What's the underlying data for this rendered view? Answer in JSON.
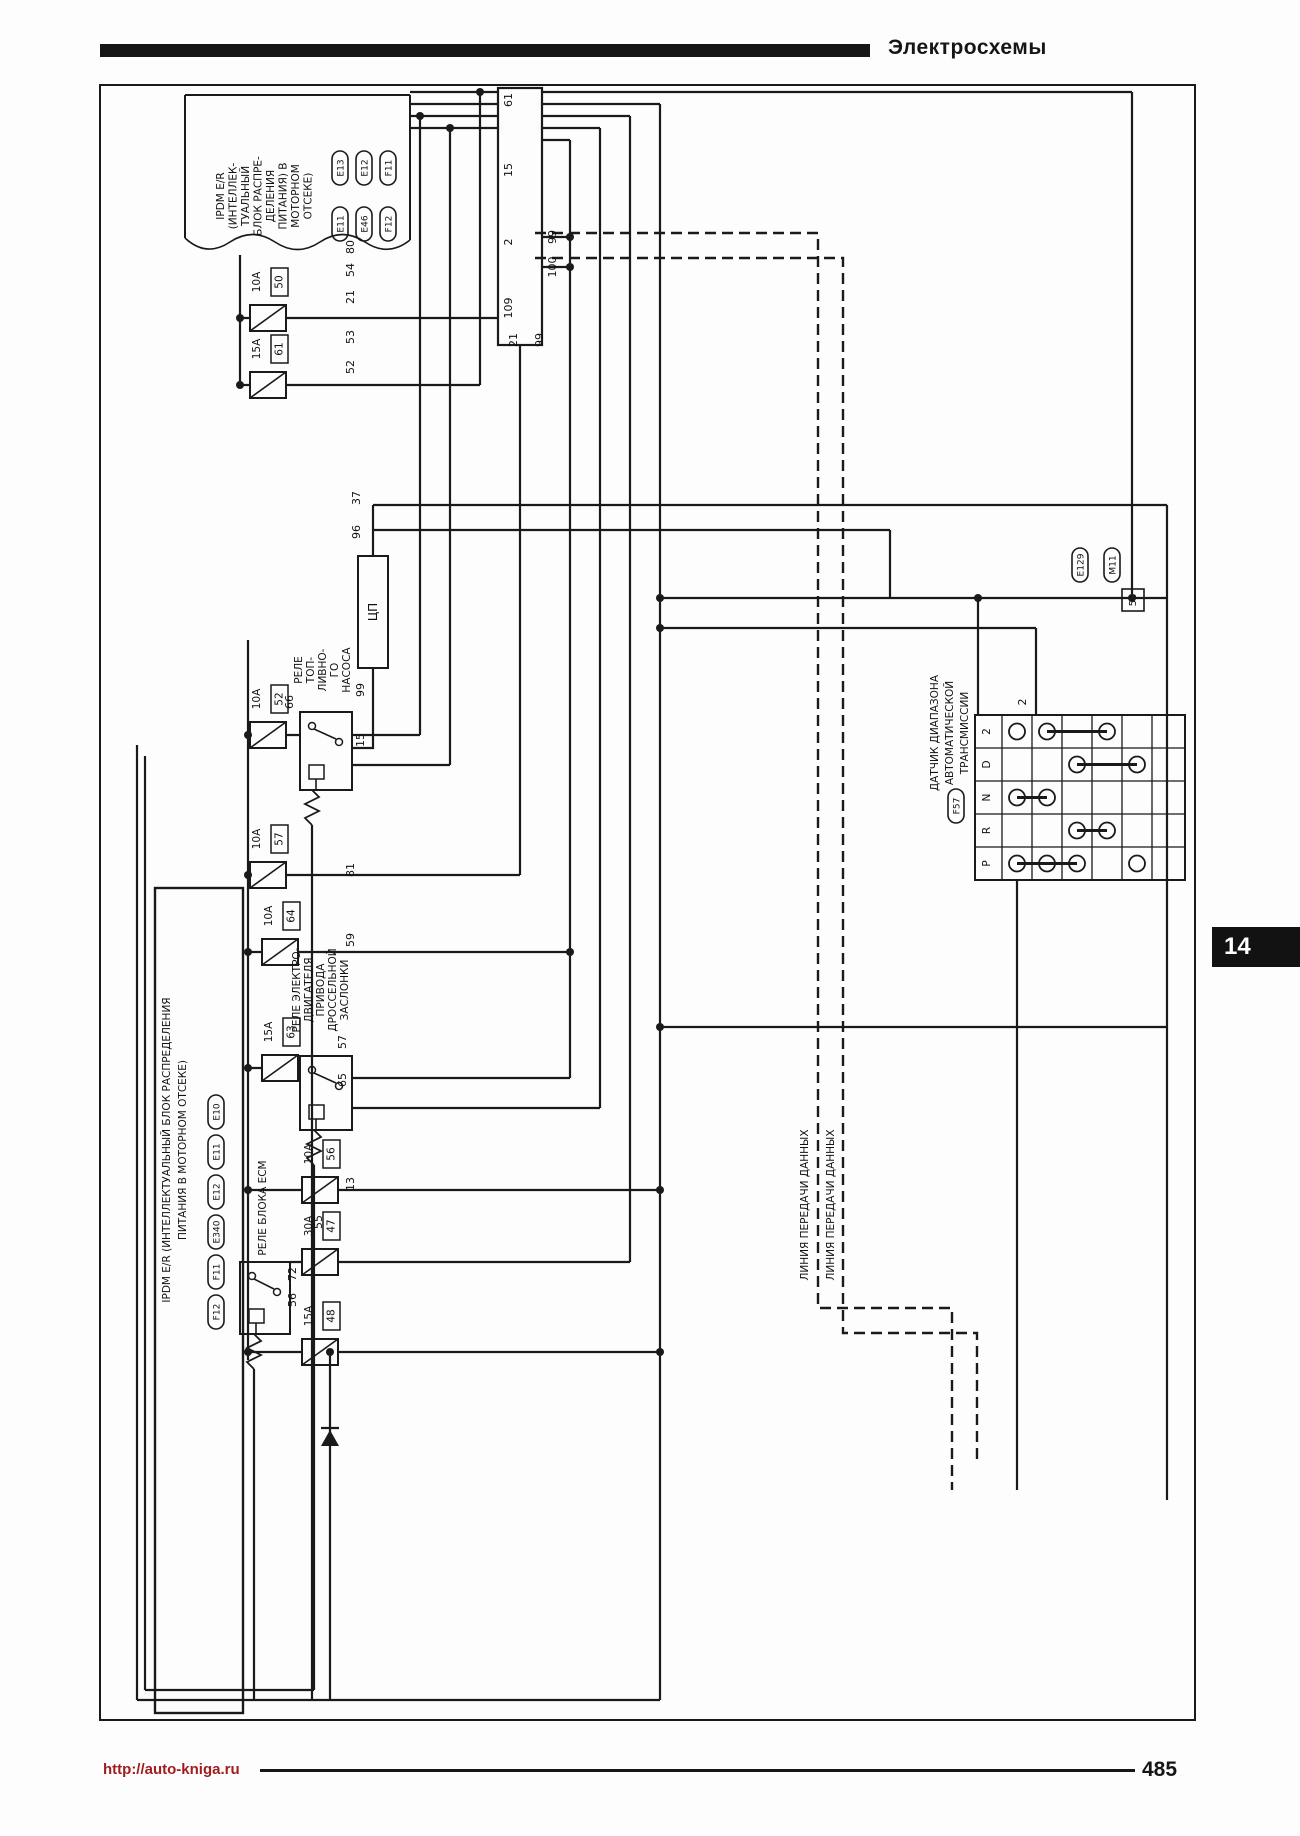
{
  "page": {
    "header_title": "Электросхемы",
    "footer_url": "http://auto-kniga.ru",
    "page_number": "485",
    "chapter_tab": "14"
  },
  "diagram": {
    "top_ipdm": {
      "label_lines": [
        "IPDM E/R",
        "(ИНТЕЛЛЕК-",
        "ТУАЛЬНЫЙ",
        "БЛОК РАСПРЕ-",
        "ДЕЛЕНИЯ",
        "ПИТАНИЯ) В",
        "МОТОРНОМ",
        "ОТСЕКЕ)"
      ],
      "connectors": [
        "E13",
        "E12",
        "F11",
        "E11",
        "E46",
        "F12"
      ]
    },
    "left_ipdm": {
      "label_lines": [
        "IPDM E/R (ИНТЕЛЛЕКТУАЛЬНЫЙ БЛОК РАСПРЕДЕЛЕНИЯ",
        "ПИТАНИЯ В МОТОРНОМ ОТСЕКЕ)"
      ],
      "connectors": [
        "E10",
        "E11",
        "E12",
        "E340",
        "F11",
        "F12"
      ]
    },
    "cpu_label": "ЦП",
    "relays": [
      {
        "name": "fuel-pump-relay",
        "label_lines": [
          "РЕЛЕ",
          "ТОП-",
          "ЛИВНО-",
          "ГО",
          "НАСОСА"
        ]
      },
      {
        "name": "throttle-motor-relay",
        "label_lines": [
          "РЕЛЕ ЭЛЕКТРО-",
          "ДВИГАТЕЛЯ",
          "ПРИВОДА",
          "ДРОССЕЛЬНОЙ",
          "ЗАСЛОНКИ"
        ]
      },
      {
        "name": "ecm-relay",
        "label_lines": [
          "РЕЛЕ БЛОКА ECM"
        ]
      }
    ],
    "fuses": [
      {
        "amp": "10A",
        "num": "50",
        "x": 268,
        "y": 318
      },
      {
        "amp": "15A",
        "num": "61",
        "x": 268,
        "y": 385
      },
      {
        "amp": "10A",
        "num": "52",
        "x": 268,
        "y": 735
      },
      {
        "amp": "10A",
        "num": "57",
        "x": 268,
        "y": 875
      },
      {
        "amp": "10A",
        "num": "64",
        "x": 280,
        "y": 952
      },
      {
        "amp": "15A",
        "num": "63",
        "x": 280,
        "y": 1068
      },
      {
        "amp": "10A",
        "num": "56",
        "x": 320,
        "y": 1190
      },
      {
        "amp": "30A",
        "num": "47",
        "x": 320,
        "y": 1262
      },
      {
        "amp": "15A",
        "num": "48",
        "x": 320,
        "y": 1352
      }
    ],
    "at_sensor": {
      "label_lines": [
        "ДАТЧИК ДИАПАЗОНА",
        "АВТОМАТИЧЕСКОЙ",
        "ТРАНСМИССИИ"
      ],
      "connector": "F57",
      "rows": [
        {
          "pos": "2",
          "circles": [
            0,
            1,
            3
          ],
          "bar": [
            1,
            3
          ]
        },
        {
          "pos": "D",
          "circles": [
            2,
            4
          ],
          "bar": [
            2,
            4
          ]
        },
        {
          "pos": "N",
          "circles": [
            0,
            1
          ],
          "bar": [
            0,
            1
          ]
        },
        {
          "pos": "R",
          "circles": [
            2,
            3
          ],
          "bar": [
            2,
            3
          ]
        },
        {
          "pos": "P",
          "circles": [
            0,
            1,
            2,
            4
          ],
          "bar": [
            0,
            2
          ]
        }
      ]
    },
    "right_connectors": {
      "pills": [
        "E129",
        "M11"
      ],
      "pin_box": "58"
    },
    "data_line_label": "ЛИНИЯ ПЕРЕДАЧИ ДАННЫХ",
    "pin_labels": [
      {
        "t": "61",
        "x": 512,
        "y": 100
      },
      {
        "t": "15",
        "x": 512,
        "y": 170
      },
      {
        "t": "2",
        "x": 512,
        "y": 242
      },
      {
        "t": "109",
        "x": 512,
        "y": 308
      },
      {
        "t": "99",
        "x": 556,
        "y": 237
      },
      {
        "t": "100",
        "x": 556,
        "y": 267
      },
      {
        "t": "21",
        "x": 517,
        "y": 340
      },
      {
        "t": "99",
        "x": 543,
        "y": 340
      },
      {
        "t": "80",
        "x": 354,
        "y": 247
      },
      {
        "t": "54",
        "x": 354,
        "y": 270
      },
      {
        "t": "21",
        "x": 354,
        "y": 297
      },
      {
        "t": "53",
        "x": 354,
        "y": 337
      },
      {
        "t": "52",
        "x": 354,
        "y": 367
      },
      {
        "t": "37",
        "x": 360,
        "y": 498
      },
      {
        "t": "96",
        "x": 360,
        "y": 532
      },
      {
        "t": "66",
        "x": 293,
        "y": 702
      },
      {
        "t": "99",
        "x": 364,
        "y": 690
      },
      {
        "t": "15",
        "x": 364,
        "y": 740
      },
      {
        "t": "81",
        "x": 354,
        "y": 870
      },
      {
        "t": "59",
        "x": 354,
        "y": 940
      },
      {
        "t": "57",
        "x": 346,
        "y": 1042
      },
      {
        "t": "65",
        "x": 346,
        "y": 1080
      },
      {
        "t": "13",
        "x": 354,
        "y": 1184
      },
      {
        "t": "55",
        "x": 322,
        "y": 1222
      },
      {
        "t": "72",
        "x": 296,
        "y": 1274
      },
      {
        "t": "56",
        "x": 296,
        "y": 1300
      },
      {
        "t": "2",
        "x": 1026,
        "y": 702
      }
    ]
  }
}
